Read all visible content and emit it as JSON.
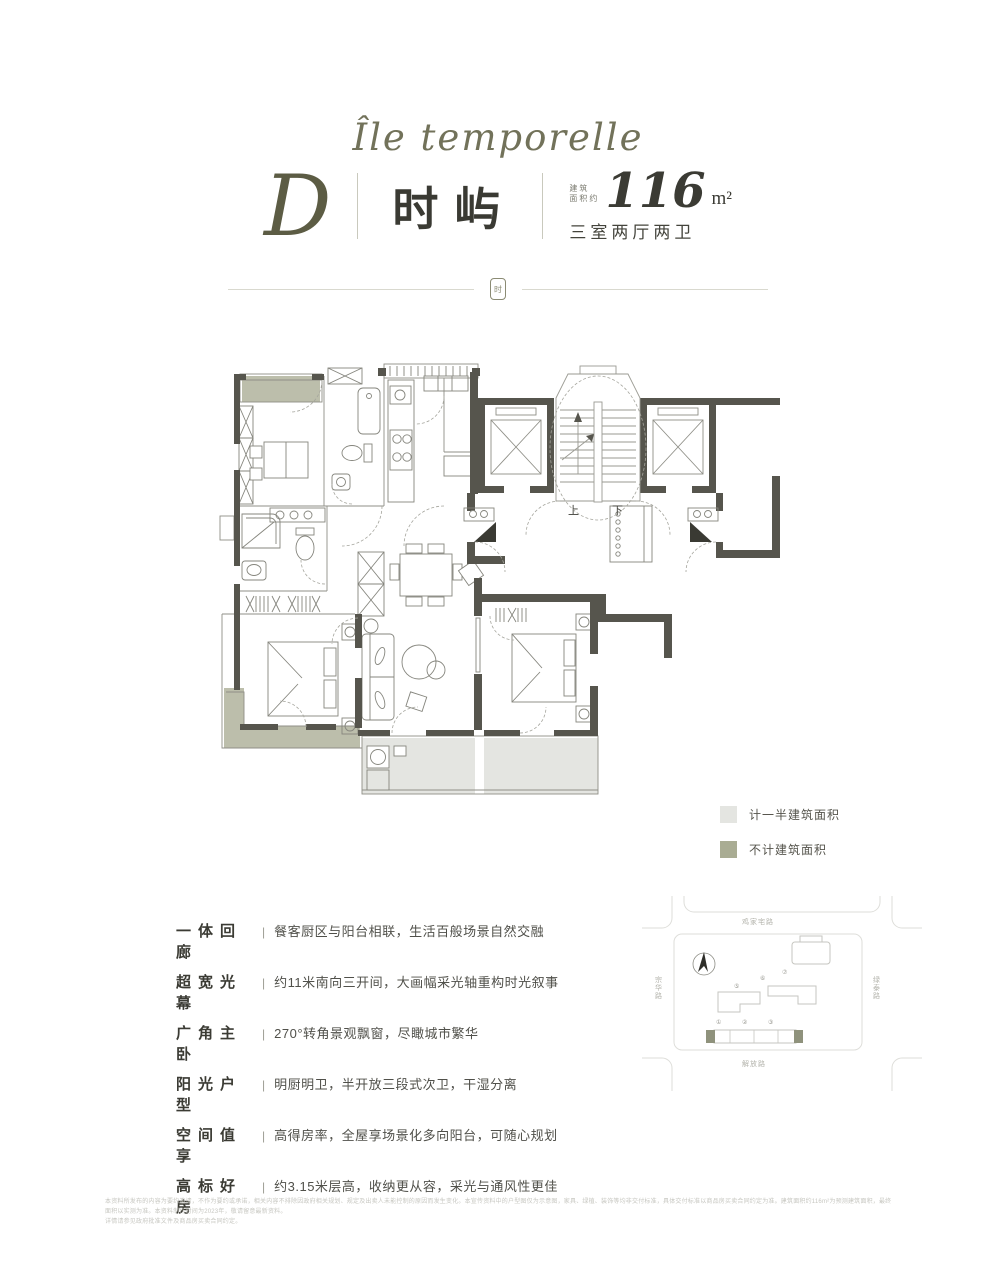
{
  "brand": {
    "script_title": "Île temporelle",
    "unit_letter": "D",
    "unit_name": "时屿",
    "area_prefix_line1": "建筑",
    "area_prefix_line2": "面积约",
    "area_value": "116",
    "area_unit": "m²",
    "layout_text": "三室两厅两卫",
    "emblem_char": "时"
  },
  "plan": {
    "stair_up": "上",
    "stair_down": "下"
  },
  "legend": {
    "items": [
      {
        "label": "计一半建筑面积",
        "color": "#e4e5e1"
      },
      {
        "label": "不计建筑面积",
        "color": "#a9ac93"
      }
    ]
  },
  "features": {
    "separator": "|",
    "items": [
      {
        "term": "一体回廊",
        "desc": "餐客厨区与阳台相联，生活百般场景自然交融"
      },
      {
        "term": "超宽光幕",
        "desc": "约11米南向三开间，大画幅采光轴重构时光叙事"
      },
      {
        "term": "广角主卧",
        "desc": "270°转角景观飘窗，尽瞰城市繁华"
      },
      {
        "term": "阳光户型",
        "desc": "明厨明卫，半开放三段式次卫，干湿分离"
      },
      {
        "term": "空间值享",
        "desc": "高得房率，全屋享场景化多向阳台，可随心规划"
      },
      {
        "term": "高标好房",
        "desc": "约3.15米层高，收纳更从容，采光与通风性更佳"
      }
    ]
  },
  "map": {
    "road_top": "鸡家宅路",
    "road_left": "宗华路",
    "road_right": "绿泰路",
    "road_bottom": "解放路",
    "numbers": [
      "①",
      "②",
      "③",
      "⑤",
      "⑥",
      "⑦"
    ]
  },
  "disclaimer": {
    "line1": "本资料所发布的内容为要约邀请，不作为要约或承诺，相关内容不排除因政府相关规划、规定及出卖人未能控制的原因而发生变化。本宣传资料中的户型图仅为示意图，家具、绿植、装饰等均非交付标准，具体交付标准以商品房买卖合同约定为准。建筑面积约116m²为预测建筑面积，最终面积以实测为准。本资料制作时间为2023年，敬请留意最新资料。",
    "line2": "详情请参见政府批准文件及商品房买卖合同约定。"
  }
}
